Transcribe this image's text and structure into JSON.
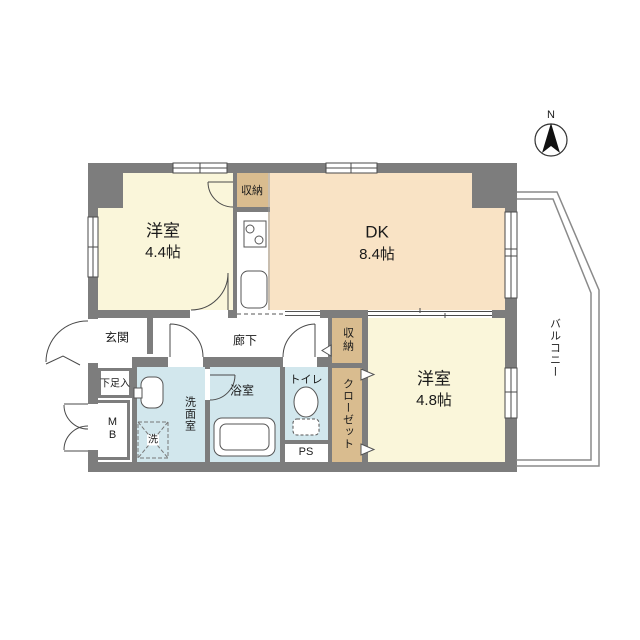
{
  "compass": {
    "north_label": "N"
  },
  "rooms": {
    "western_room_1": {
      "name": "洋室",
      "size": "4.4帖"
    },
    "dk": {
      "name": "DK",
      "size": "8.4帖"
    },
    "western_room_2": {
      "name": "洋室",
      "size": "4.8帖"
    }
  },
  "labels": {
    "storage_top": "収納",
    "storage_hall": "収納",
    "closet": "クローゼット",
    "entrance": "玄関",
    "hallway": "廊下",
    "shoe_cabinet": "下足入",
    "meter_box": "MB",
    "washroom": "洗面室",
    "bathroom": "浴室",
    "washing_machine": "洗",
    "toilet": "トイレ",
    "pipe_space": "PS",
    "balcony": "バルコニー"
  },
  "colors": {
    "wall": "#7d7d7d",
    "western_room": "#faf6da",
    "dk": "#f9e3c5",
    "storage": "#d9bc8f",
    "wet_area": "#d2e7ed"
  }
}
